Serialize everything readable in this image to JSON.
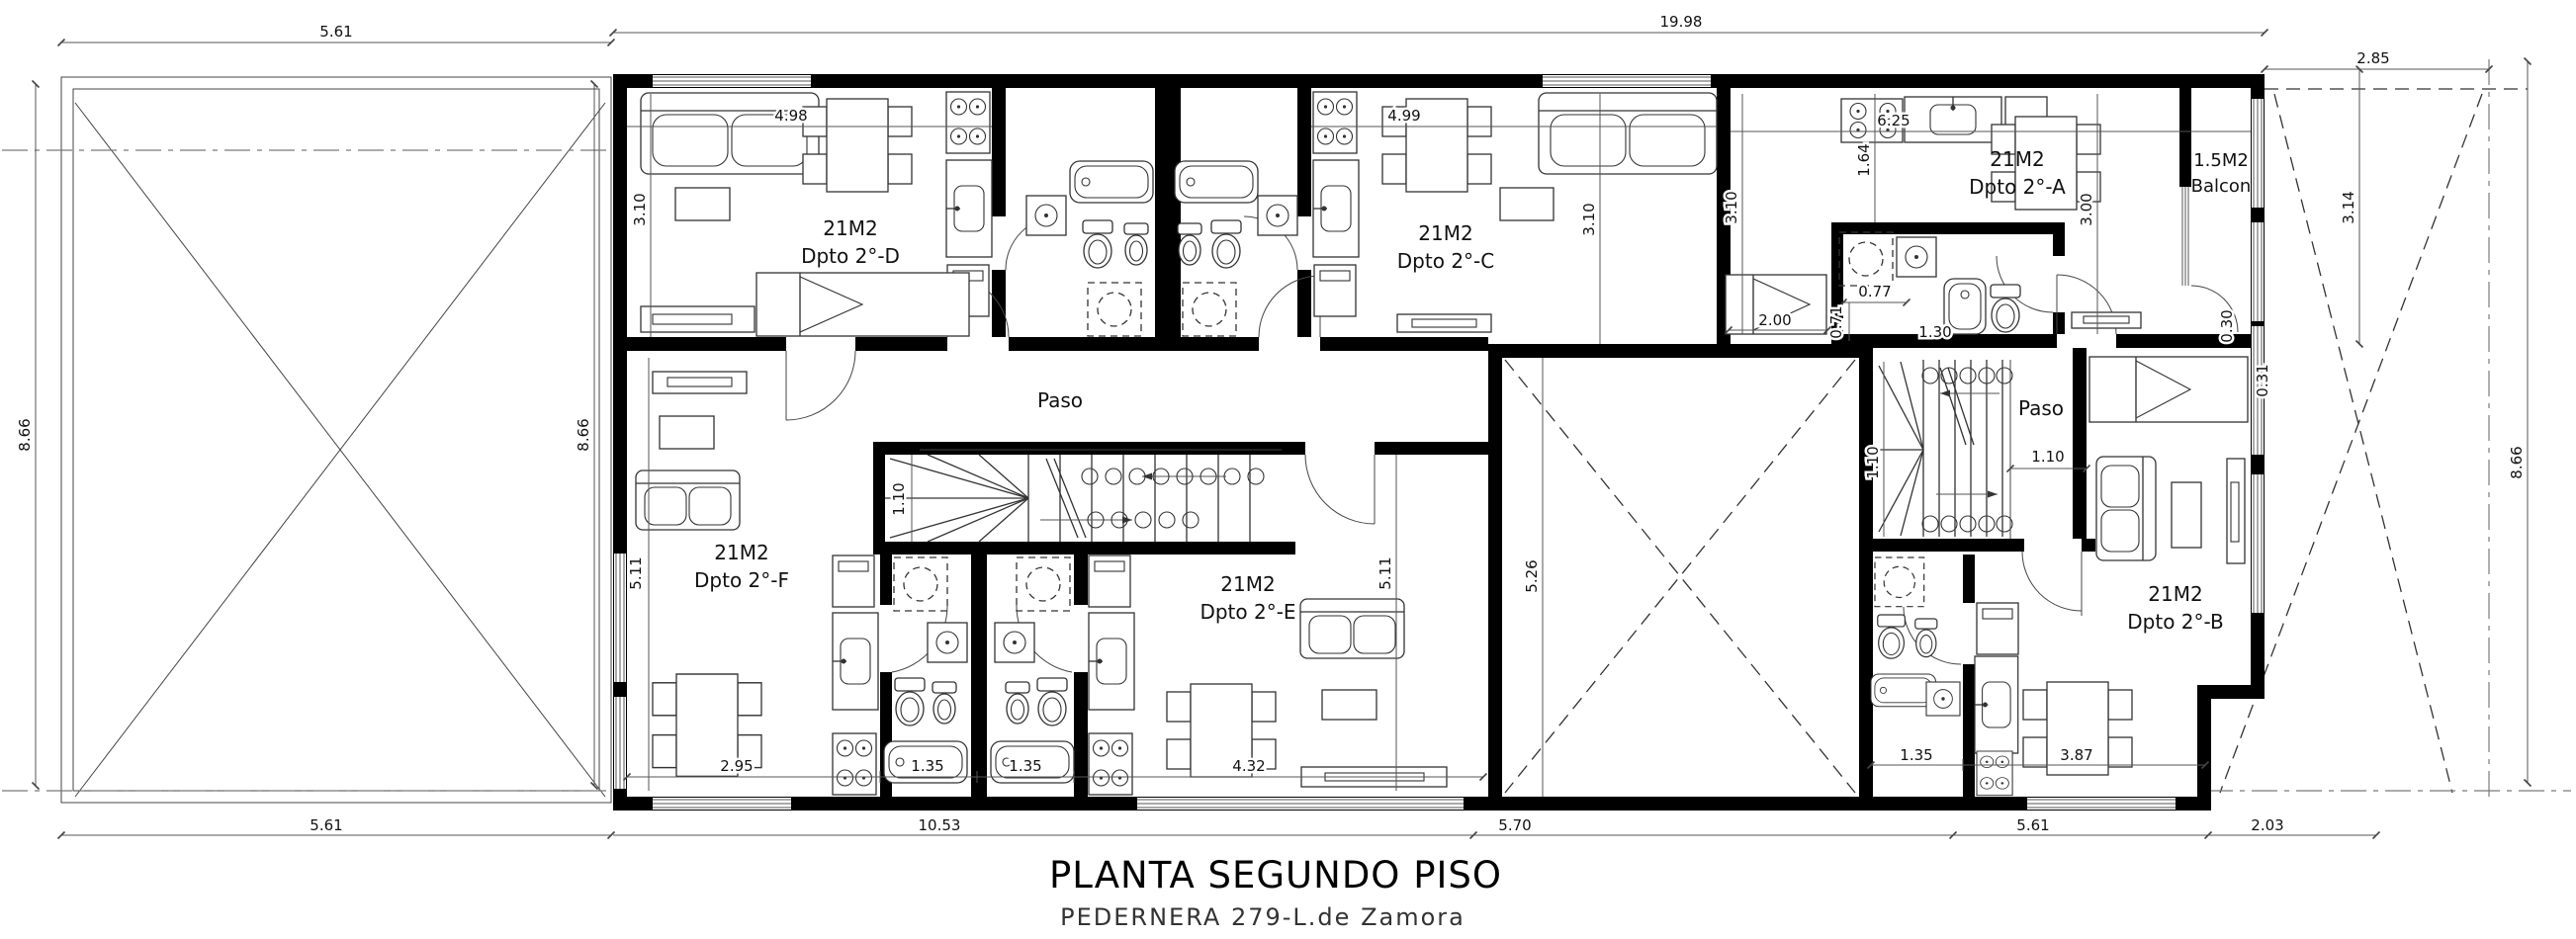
{
  "title": {
    "main": "PLANTA SEGUNDO PISO",
    "sub": "PEDERNERA 279-L.de Zamora"
  },
  "rooms": {
    "d": {
      "area": "21M2",
      "name": "Dpto 2°-D"
    },
    "c": {
      "area": "21M2",
      "name": "Dpto 2°-C"
    },
    "a": {
      "area": "21M2",
      "name": "Dpto 2°-A"
    },
    "balcony": {
      "area": "1.5M2",
      "name": "Balcon"
    },
    "f": {
      "area": "21M2",
      "name": "Dpto 2°-F"
    },
    "e": {
      "area": "21M2",
      "name": "Dpto 2°-E"
    },
    "b": {
      "area": "21M2",
      "name": "Dpto 2°-B"
    },
    "hall_left": {
      "name": "Paso"
    },
    "hall_right": {
      "name": "Paso"
    }
  },
  "dims": {
    "terrace_top": "5.61",
    "building_top": "19.98",
    "yard_top": "2.85",
    "terrace_left": "8.66",
    "building_left": "8.66",
    "yard_right": "8.66",
    "yard_height": "3.14",
    "d_width": "4.98",
    "c_width": "4.99",
    "a_width": "6.25",
    "d_depth": "3.10",
    "c_depth": "3.10",
    "a_left_depth": "3.10",
    "a_kitchen": "1.64",
    "a_right_depth": "3.00",
    "a_bed": "2.00",
    "a_bath_width": "0.77",
    "a_bath_depth": "0.71",
    "a_bath_tub": "1.30",
    "balcony_door": "0.30",
    "balcony_wall": "0.31",
    "stair_left_width": "1.10",
    "stair_right_width": "1.10",
    "hall_right_width": "1.10",
    "f_depth": "5.11",
    "e_depth": "5.11",
    "patio_depth": "5.26",
    "f_table": "2.95",
    "f_bath_width": "1.35",
    "e_bath_width": "1.35",
    "e_width": "4.32",
    "b_bath_width": "1.35",
    "b_width": "3.87",
    "bottom_terrace": "5.61",
    "bottom_left": "10.53",
    "bottom_center": "5.70",
    "bottom_right": "5.61",
    "bottom_yard": "2.03"
  },
  "colors": {
    "paper": "#ffffff",
    "ink": "#000000"
  }
}
